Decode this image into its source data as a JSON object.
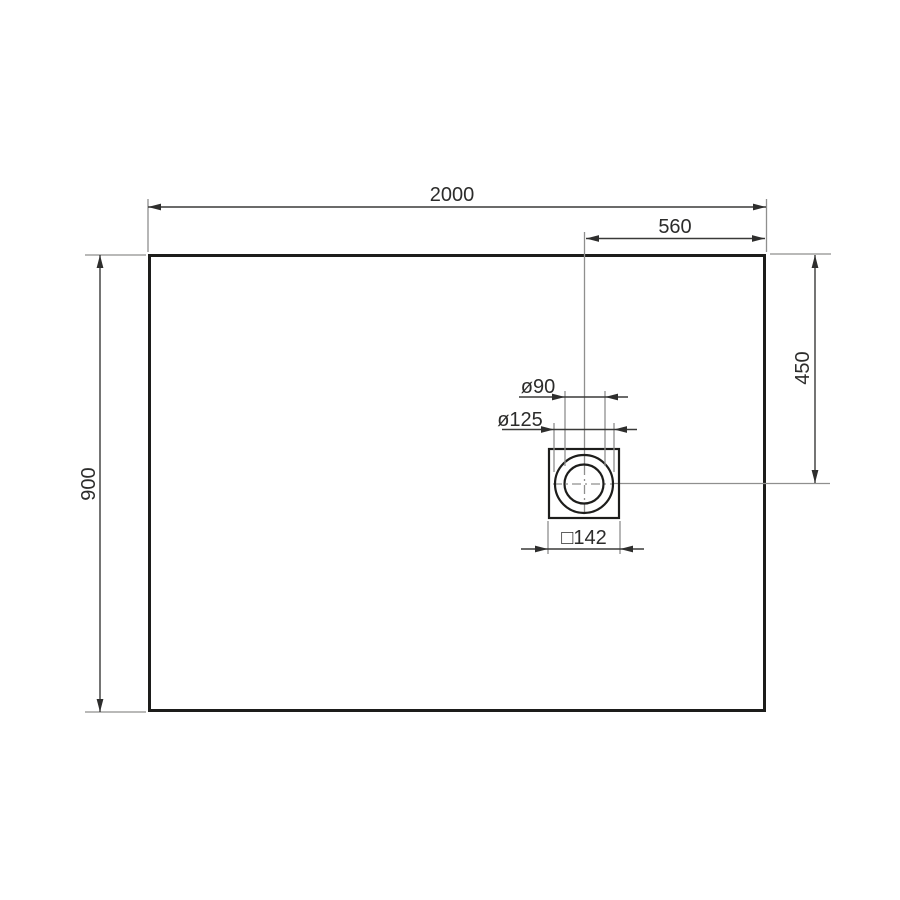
{
  "drawing": {
    "title": "shower tray top-view dimension drawing",
    "type": "technical-dimension-drawing",
    "subject": "rectangular tray with offset round waste drain in square frame",
    "labels": {
      "overall_length": "2000",
      "overall_width": "900",
      "drain_offset_from_right": "560",
      "drain_offset_from_top": "450",
      "drain_inner_diameter": "ø90",
      "drain_outer_diameter": "ø125",
      "drain_square_frame": "□142"
    },
    "colors": {
      "background": "#ffffff",
      "outline": "#1d1d1b",
      "dimension_line": "#3a3a39",
      "extension_line": "#8f8f8e",
      "text": "#2c2c2b"
    }
  }
}
